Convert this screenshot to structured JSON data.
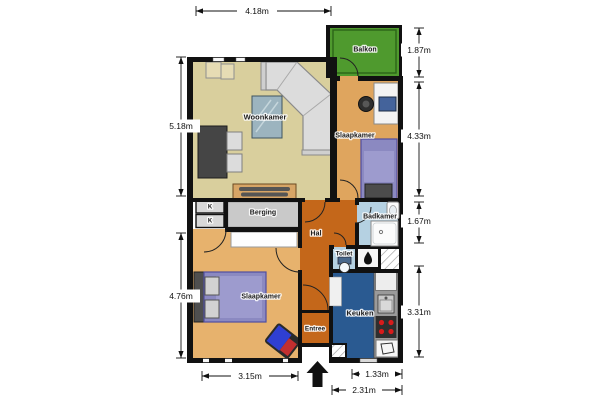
{
  "plan": {
    "title": "apartment-floor-plan",
    "rooms": {
      "woonkamer": "Woonkamer",
      "slaapkamer_boven": "Slaapkamer",
      "slaapkamer_beneden": "Slaapkamer",
      "balkon": "Balkon",
      "berging": "Berging",
      "hal": "Hal",
      "badkamer": "Badkamer",
      "toilet": "Toilet",
      "keuken": "Keuken",
      "entree": "Entree",
      "kast_1": "K",
      "kast_2": "K"
    },
    "dimensions": {
      "top_width": "4.18m",
      "left_upper": "5.18m",
      "left_lower": "4.76m",
      "right_balkon": "1.87m",
      "right_slaapkamer": "4.33m",
      "right_badkamer": "1.67m",
      "right_keuken": "3.31m",
      "bottom_slaapkamer": "3.15m",
      "bottom_keuken_inner": "1.33m",
      "bottom_keuken_outer": "2.31m"
    },
    "colors": {
      "wall": "#111111",
      "woonkamer": "#d9cf9d",
      "slaapkamer_boven": "#dfa55e",
      "slaapkamer_beneden": "#e7b26d",
      "balkon": "#4f9a2e",
      "balkon_rail": "#2b6418",
      "hal_entree": "#c4671a",
      "badkamer_toilet": "#b5d1e2",
      "keuken": "#2a5a91",
      "berging": "#c9c9c9",
      "bed": "#8b89c1",
      "stove_burner": "#d81b1b"
    },
    "icons": {
      "entrance_arrow": "entrance-arrow",
      "boiler_flame": "boiler-flame"
    }
  }
}
